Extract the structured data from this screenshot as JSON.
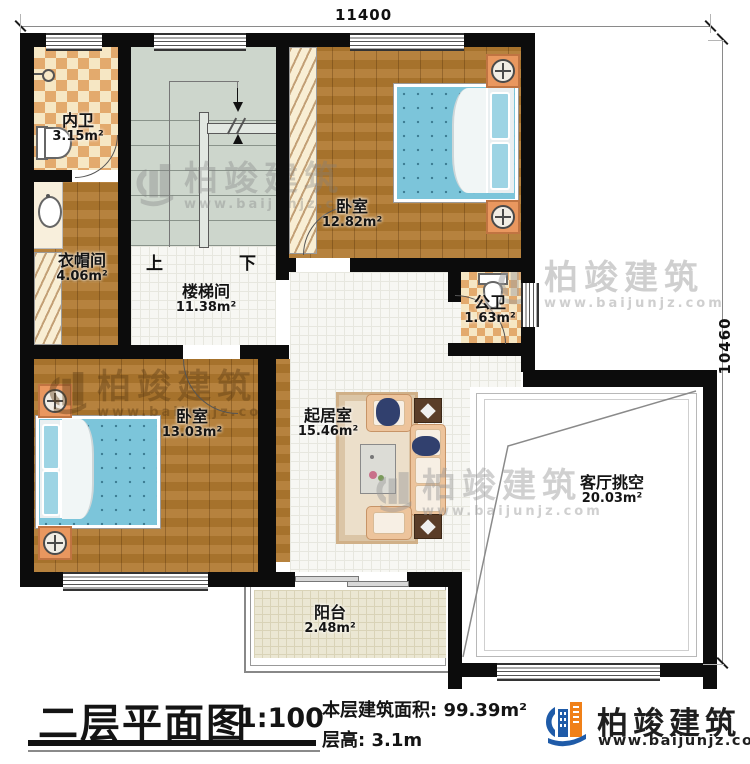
{
  "dimensions": {
    "top": "11400",
    "right": "10460"
  },
  "rooms": {
    "neiwei": {
      "name": "内卫",
      "area": "3.15m²"
    },
    "bedroom1": {
      "name": "卧室",
      "area": "12.82m²"
    },
    "cloakroom": {
      "name": "衣帽间",
      "area": "4.06m²"
    },
    "stairwell": {
      "name": "楼梯间",
      "area": "11.38m²"
    },
    "gongwei": {
      "name": "公卫",
      "area": "1.63m²"
    },
    "bedroom2": {
      "name": "卧室",
      "area": "13.03m²"
    },
    "living": {
      "name": "起居室",
      "area": "15.46m²"
    },
    "void": {
      "name": "客厅挑空",
      "area": "20.03m²"
    },
    "balcony": {
      "name": "阳台",
      "area": "2.48m²"
    }
  },
  "stairs": {
    "up_label": "上",
    "down_label": "下"
  },
  "title_block": {
    "title": "二层平面图",
    "scale": "1:100",
    "area_label": "本层建筑面积:",
    "area_value": "99.39m²",
    "floor_height_label": "层高:",
    "floor_height_value": "3.1m"
  },
  "brand": {
    "name": "柏竣建筑",
    "website": "www.baijunjz.com"
  },
  "watermark": {
    "name": "柏竣建筑",
    "website": "www.baijunjz.com"
  },
  "colors": {
    "wall": "#0c0c0c",
    "wood_floor": "#b0792f",
    "tile_accent": "#e3aa6d",
    "stair_floor": "#cdd6cc",
    "bed": "#7cc5da",
    "logo_blue": "#1f5ba8",
    "logo_orange": "#f08018"
  }
}
